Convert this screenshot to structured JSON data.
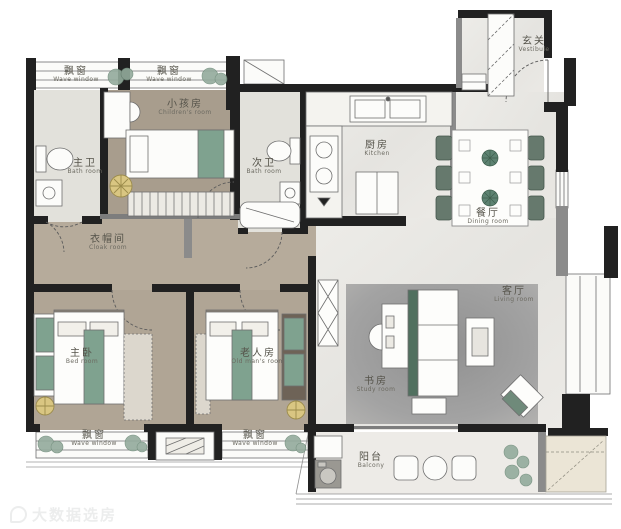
{
  "title": "apartment-floor-plan",
  "colors": {
    "wall": "#212121",
    "wall_gray": "#8b8b8b",
    "wood_floor": "#b2a796",
    "tile_floor": "#e2e1db",
    "marble_floor": "#e9e8e4",
    "carpet": "#9d9d9d",
    "furniture_teal": "#7fa28f",
    "chair_green": "#66796d",
    "accent_gold": "#d9c682",
    "ac_platform": "#ebe5d6"
  },
  "watermark": {
    "text": "大数据选房"
  },
  "rooms": [
    {
      "id": "vestibule",
      "zh": "玄关",
      "en": "Vestibule"
    },
    {
      "id": "wave-window-top-left",
      "zh": "飘窗",
      "en": "Wave window"
    },
    {
      "id": "wave-window-top-mid",
      "zh": "飘窗",
      "en": "Wave window"
    },
    {
      "id": "children-room",
      "zh": "小孩房",
      "en": "Children's room"
    },
    {
      "id": "master-bath",
      "zh": "主卫",
      "en": "Bath room"
    },
    {
      "id": "second-bath",
      "zh": "次卫",
      "en": "Bath room"
    },
    {
      "id": "kitchen",
      "zh": "厨房",
      "en": "Kitchen"
    },
    {
      "id": "dining-room",
      "zh": "餐厅",
      "en": "Dining room"
    },
    {
      "id": "cloak-room",
      "zh": "衣帽间",
      "en": "Cloak room"
    },
    {
      "id": "living-room",
      "zh": "客厅",
      "en": "Living room"
    },
    {
      "id": "master-bedroom",
      "zh": "主卧",
      "en": "Bed room"
    },
    {
      "id": "old-mans-room",
      "zh": "老人房",
      "en": "Old man's room"
    },
    {
      "id": "study-room",
      "zh": "书房",
      "en": "Study room"
    },
    {
      "id": "wave-window-bottom-left",
      "zh": "飘窗",
      "en": "Wave window"
    },
    {
      "id": "wave-window-bottom-mid",
      "zh": "飘窗",
      "en": "Wave window"
    },
    {
      "id": "balcony",
      "zh": "阳台",
      "en": "Balcony"
    }
  ]
}
